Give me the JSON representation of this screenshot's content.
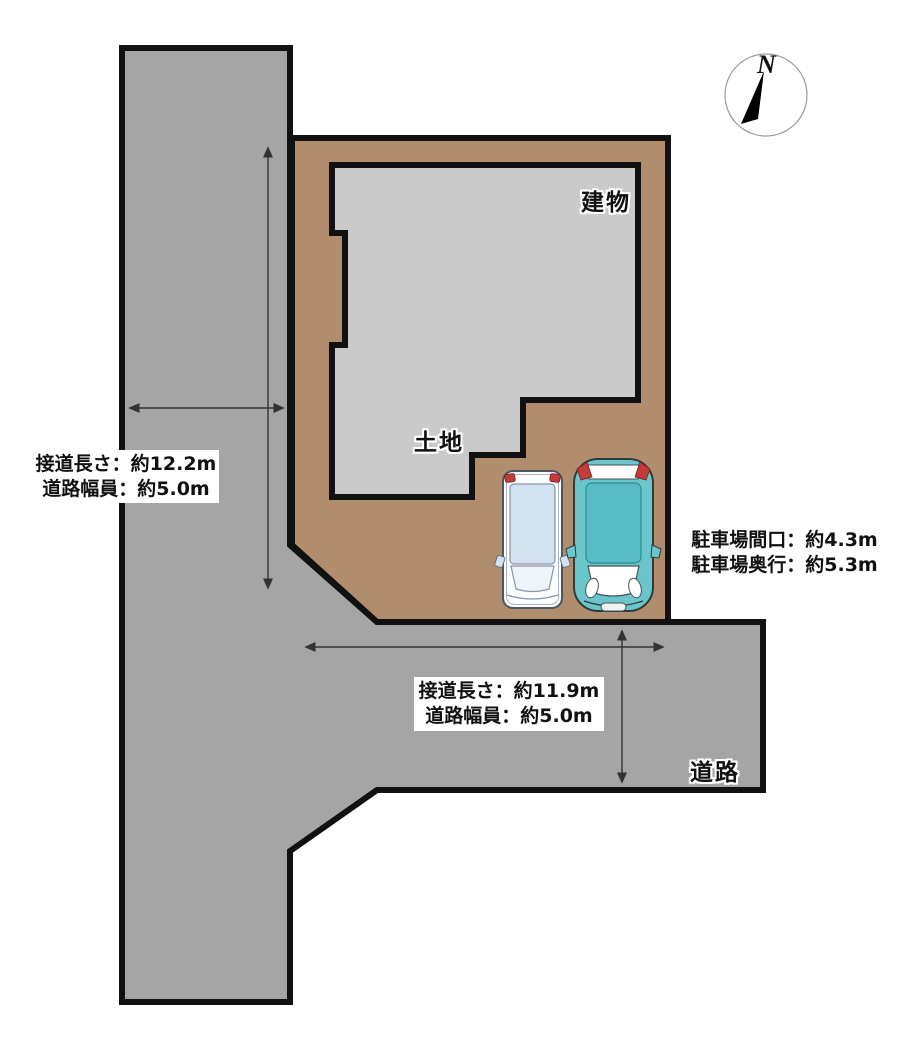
{
  "scene": {
    "compass": {
      "north": "N"
    },
    "areas": {
      "building_label": "建物",
      "land_label": "土地",
      "road_label": "道路"
    },
    "measurement_boxes": {
      "left_road": {
        "line1": "接道長さ：約12.2m",
        "line2": "道路幅員：約5.0m"
      },
      "bottom_road": {
        "line1": "接道長さ：約11.9m",
        "line2": "道路幅員：約5.0m"
      },
      "parking": {
        "line1": "駐車場間口：約4.3m",
        "line2": "駐車場奥行：約5.3m"
      }
    },
    "colors": {
      "road": "#a5a5a5",
      "land": "#b08e6d",
      "building": "#cacaca",
      "outline": "#111111",
      "arrow": "#333333",
      "car_white_body": "#fbfdff",
      "car_white_glass": "#d3e2f0",
      "car_teal_body": "#6ac6cb",
      "car_teal_roof": "#57bcc3",
      "taillight_red": "#c23b3b"
    }
  }
}
